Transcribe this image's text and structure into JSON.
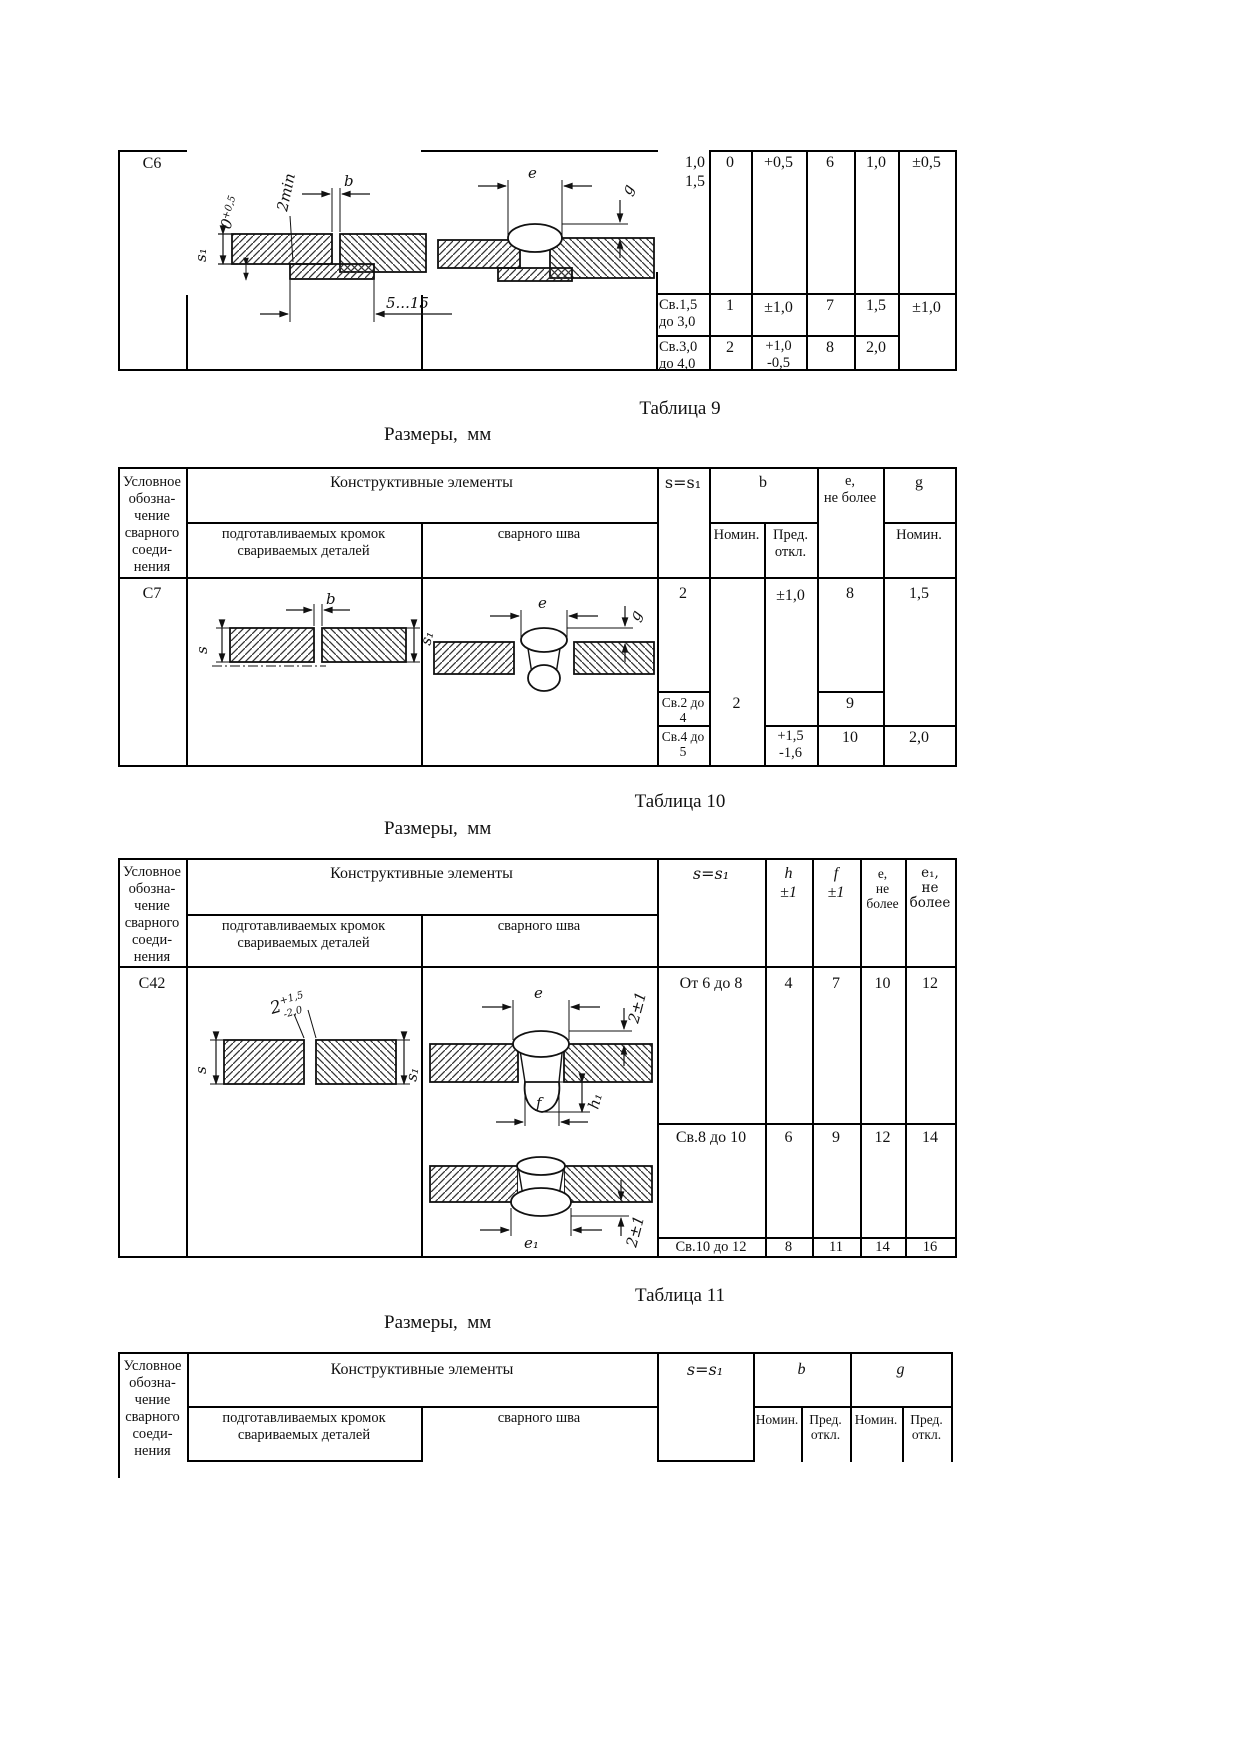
{
  "captions": {
    "t9": "Таблица 9",
    "t10": "Таблица 10",
    "t11": "Таблица 11",
    "sizes": "Размеры,  мм"
  },
  "hdr": {
    "symbol": "Условное\nобозна-\nчение\nсварного\nсоеди-\nнения",
    "constructive": "Конструктивные элементы",
    "prep": "подготавливаемых кромок\nсвариваемых деталей",
    "weld": "сварного шва",
    "nom": "Номин.",
    "dev": "Пред.\nоткл."
  },
  "t8": {
    "joint": "С6",
    "labels": {
      "s1": "s₁",
      "gap0": "0",
      "gap0t": "+0,5",
      "min2": "2min",
      "b": "b",
      "w": "5...15",
      "e": "e",
      "g": "g"
    },
    "r1": {
      "s": "1,0\n1,5",
      "bn": "0",
      "bd": "+0,5",
      "e": "6",
      "gn": "1,0",
      "gd": "±0,5"
    },
    "r2": {
      "s": "Св.1,5\nдо 3,0",
      "bn": "1",
      "bd": "±1,0",
      "e": "7",
      "gn": "1,5",
      "gd": "±1,0"
    },
    "r3": {
      "s": "Св.3,0\nдо 4,0",
      "bn": "2",
      "bd": "+1,0\n-0,5",
      "e": "8",
      "gn": "2,0"
    }
  },
  "t9": {
    "joint": "С7",
    "cols": {
      "s": "s=s₁",
      "b": "b",
      "e": "е,\nне более",
      "g": "g"
    },
    "labels": {
      "s": "s",
      "s1": "s₁",
      "b": "b",
      "e": "e",
      "g": "g"
    },
    "r1": {
      "s": "2",
      "bd": "±1,0",
      "e": "8",
      "g": "1,5"
    },
    "r2": {
      "s": "Св.2 до\n4",
      "bn": "2",
      "e": "9"
    },
    "r3": {
      "s": "Св.4 до\n5",
      "bd": "+1,5\n-1,6",
      "e": "10",
      "g": "2,0"
    }
  },
  "t10": {
    "joint": "С42",
    "cols": {
      "s": "s=s₁",
      "h": "h\n±1",
      "f": "f\n±1",
      "e": "е,\nне\nболее",
      "e1": "е₁,\nне\nболее"
    },
    "labels": {
      "g2": "2",
      "g2sup": "+1,5",
      "g2sub": "-2,0",
      "s": "s",
      "s1": "s₁",
      "e": "e",
      "t21": "2±1",
      "h1": "h₁",
      "f": "f",
      "e1": "e₁",
      "t21b": "2±1"
    },
    "r1": {
      "s": "От 6 до 8",
      "h": "4",
      "f": "7",
      "e": "10",
      "e1": "12"
    },
    "r2": {
      "s": "Св.8 до 10",
      "h": "6",
      "f": "9",
      "e": "12",
      "e1": "14"
    },
    "r3": {
      "s": "Св.10 до 12",
      "h": "8",
      "f": "11",
      "e": "14",
      "e1": "16"
    }
  },
  "t11": {
    "cols": {
      "s": "s=s₁",
      "b": "b",
      "g": "g"
    }
  }
}
